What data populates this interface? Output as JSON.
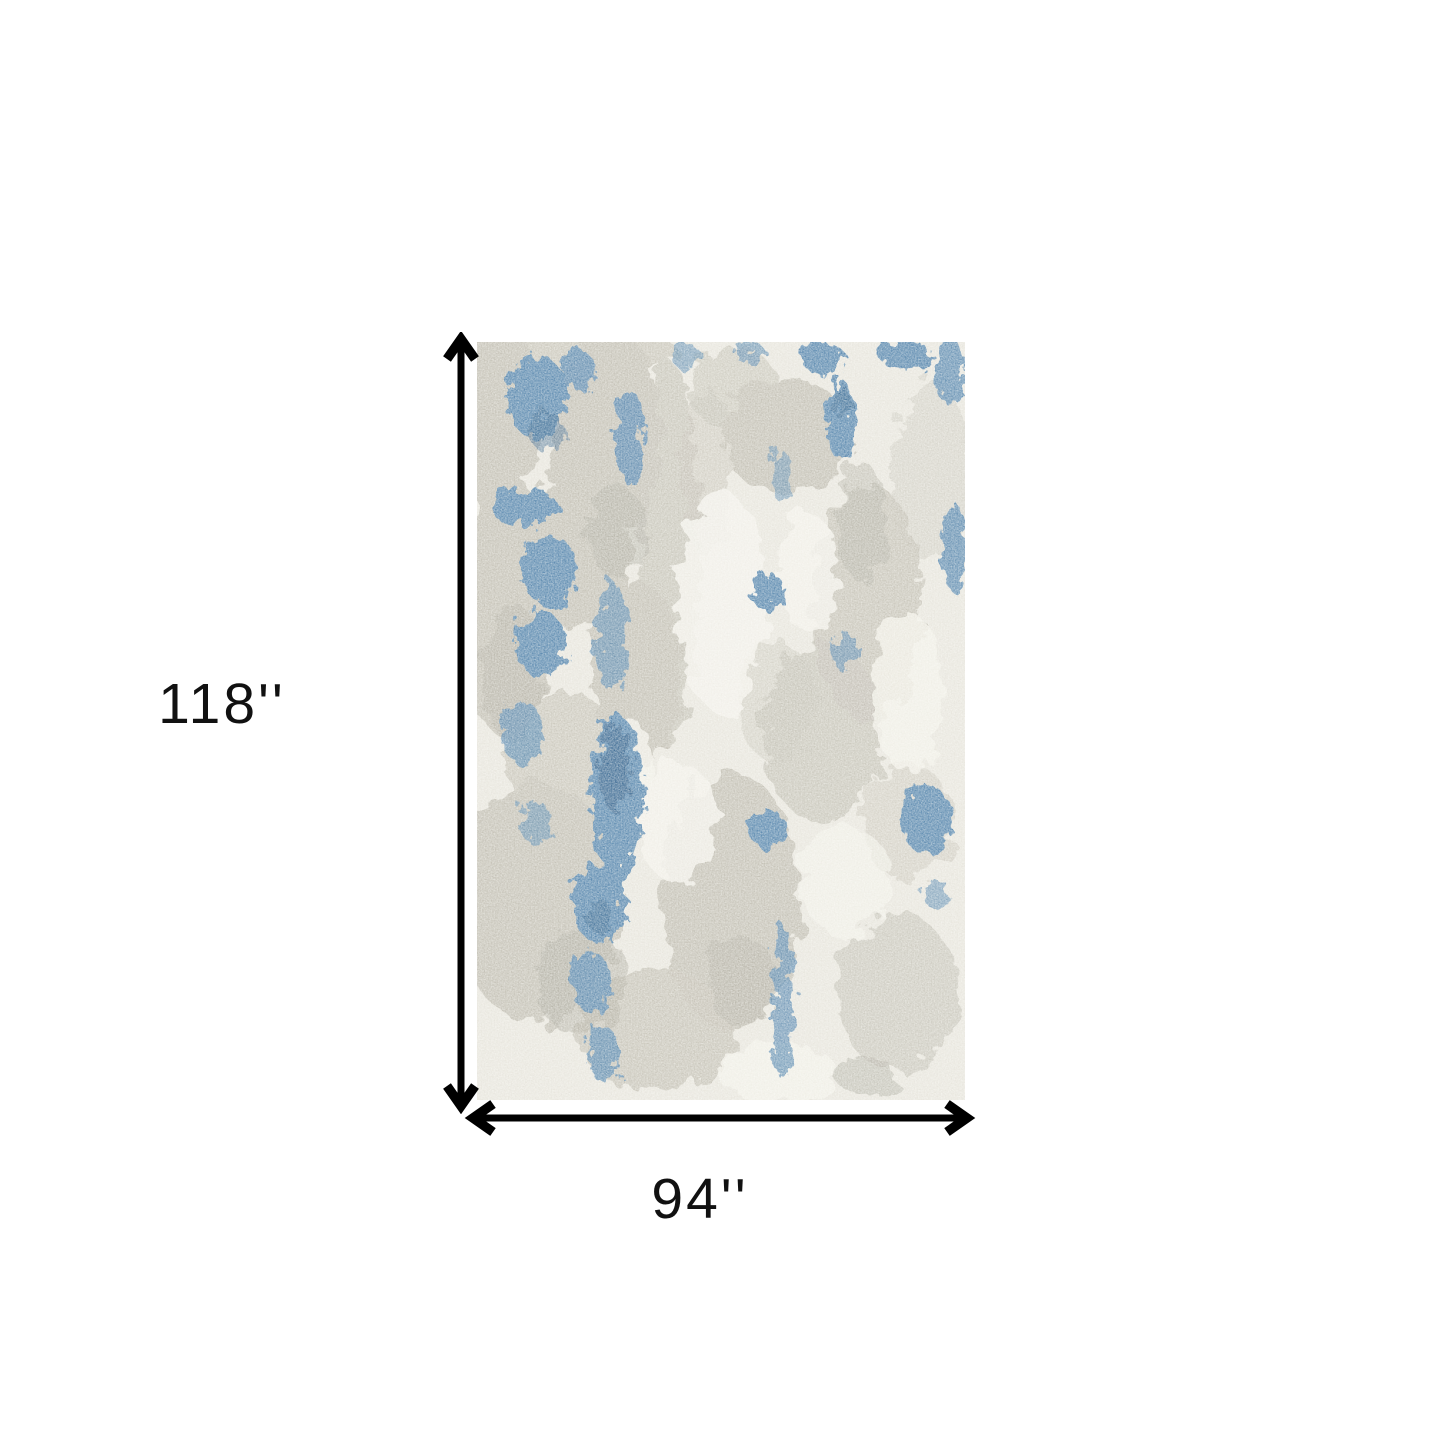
{
  "page": {
    "title": "Rug dimensions diagram",
    "background_color": "#ffffff"
  },
  "diagram": {
    "height_label": "118''",
    "width_label": "94''",
    "arrow_color": "#000000",
    "label_color": "#111111"
  },
  "rug": {
    "description": "Abstract distressed area rug swatch in ivory, greige and blue",
    "palette": {
      "base": "#e8e6de",
      "ivory": "#f2f1ea",
      "gray": "#c6c3b8",
      "gray_dark": "#b1afa4",
      "blue": "#5e8cb1",
      "blue_light": "#8fb2ca",
      "blue_dark": "#39658d"
    }
  }
}
